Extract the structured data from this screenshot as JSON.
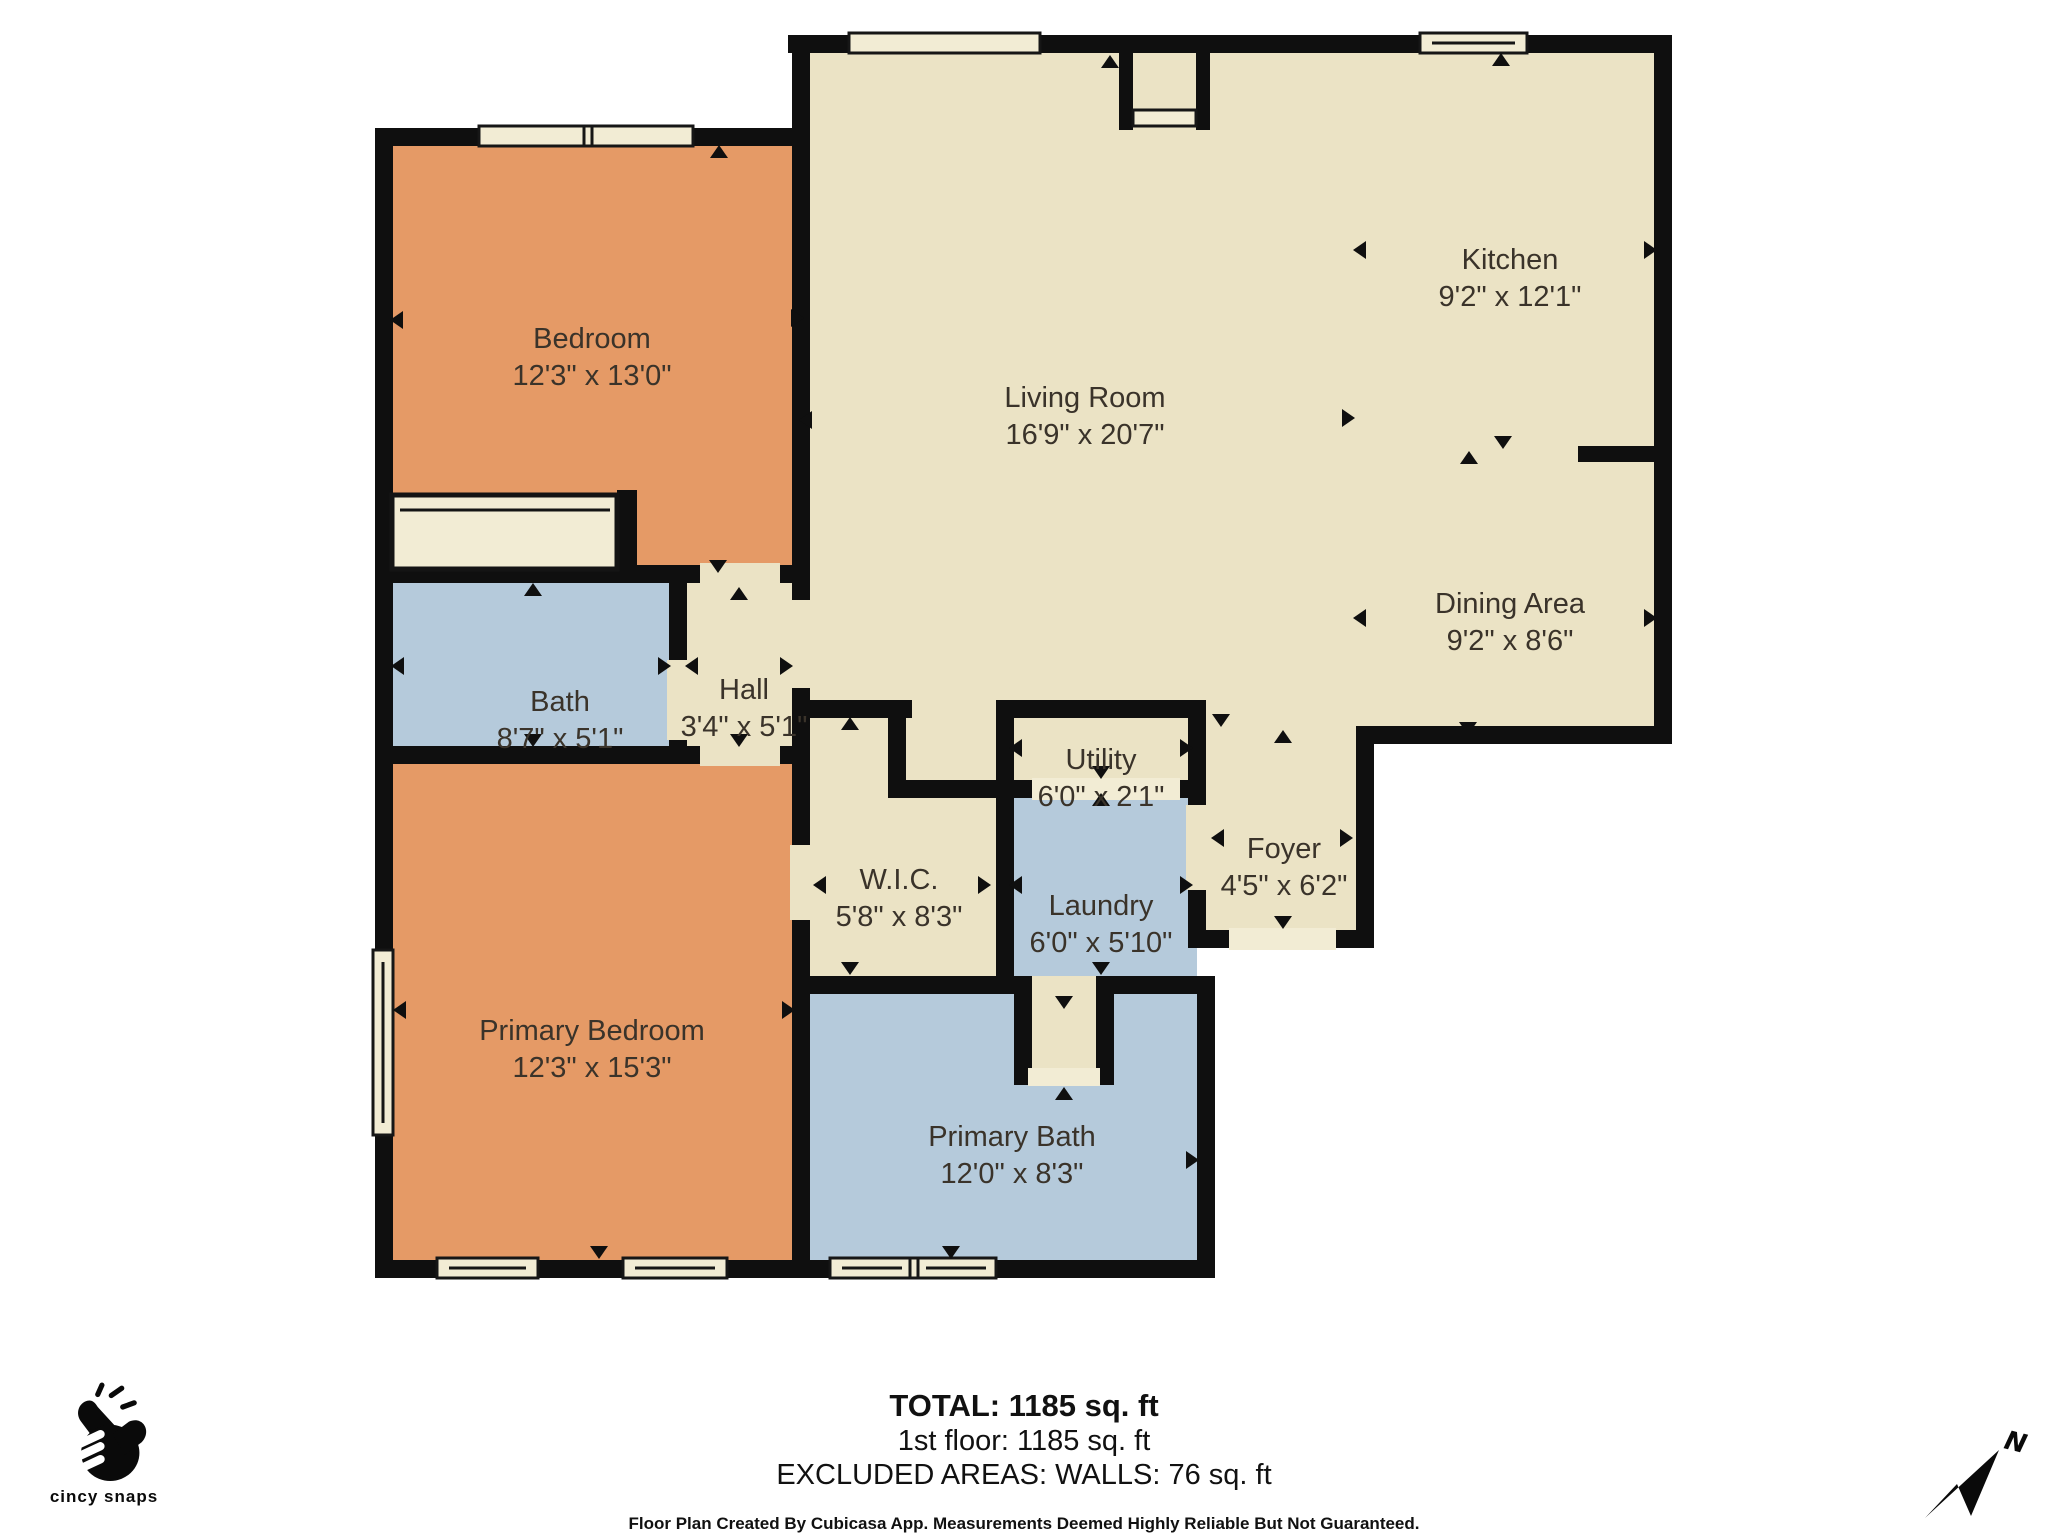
{
  "rooms": [
    {
      "key": "bedroom",
      "name": "Bedroom",
      "dims": "12'3\" x 13'0\""
    },
    {
      "key": "living-room",
      "name": "Living Room",
      "dims": "16'9\" x 20'7\""
    },
    {
      "key": "kitchen",
      "name": "Kitchen",
      "dims": "9'2\" x 12'1\""
    },
    {
      "key": "dining-area",
      "name": "Dining Area",
      "dims": "9'2\" x 8'6\""
    },
    {
      "key": "bath",
      "name": "Bath",
      "dims": "8'7\" x 5'1\""
    },
    {
      "key": "hall",
      "name": "Hall",
      "dims": "3'4\" x 5'1\""
    },
    {
      "key": "utility",
      "name": "Utility",
      "dims": "6'0\" x 2'1\""
    },
    {
      "key": "wic",
      "name": "W.I.C.",
      "dims": "5'8\" x 8'3\""
    },
    {
      "key": "laundry",
      "name": "Laundry",
      "dims": "6'0\" x 5'10\""
    },
    {
      "key": "foyer",
      "name": "Foyer",
      "dims": "4'5\" x 6'2\""
    },
    {
      "key": "primary-bedroom",
      "name": "Primary Bedroom",
      "dims": "12'3\" x 15'3\""
    },
    {
      "key": "primary-bath",
      "name": "Primary Bath",
      "dims": "12'0\" x 8'3\""
    }
  ],
  "summary": {
    "total": "TOTAL: 1185 sq. ft",
    "floor": "1st floor: 1185 sq. ft",
    "excluded": "EXCLUDED AREAS: WALLS: 76 sq. ft",
    "disclaimer": "Floor Plan Created By Cubicasa App. Measurements Deemed Highly Reliable But Not Guaranteed."
  },
  "branding": {
    "logo_text": "cincy snaps"
  },
  "compass": {
    "north_label": "N"
  },
  "colors": {
    "wall": "#0f0f0f",
    "room_cream": "#ebe3c5",
    "room_orange": "#e59a66",
    "room_blue": "#b5cadb",
    "window_fill": "#f2ecd4",
    "background": "#ffffff"
  }
}
